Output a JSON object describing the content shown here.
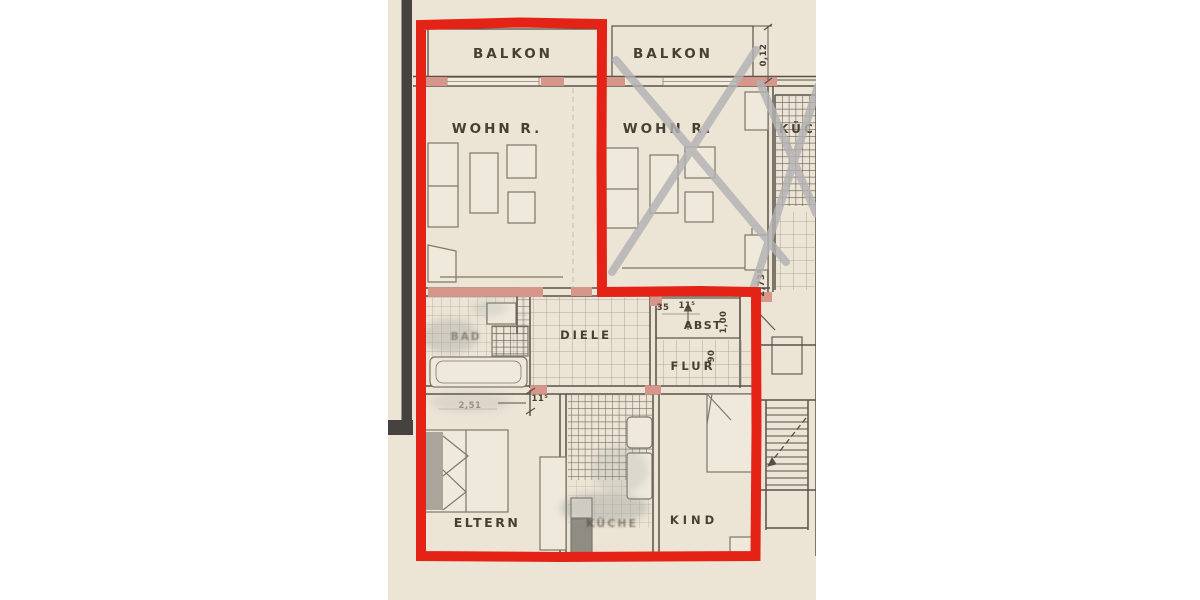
{
  "palette": {
    "paper": "#ece4d5",
    "ink": "#473f33",
    "wall_line": "#57514a",
    "furniture_line": "#7d776b",
    "pink_wall_fill": "#d6968a",
    "highlight_red": "#e42117",
    "cross_grey": "#b3b3b3",
    "dark_bar": "#454341"
  },
  "labels": {
    "balcony_left": "BALKON",
    "balcony_right": "BALKON",
    "living_left": "WOHN R.",
    "living_right": "WOHN R.",
    "kitchen_right": "KÜCHE",
    "bath": "BAD",
    "hallway": "DIELE",
    "storage": "ABST",
    "corridor": "FLUR",
    "parents": "ELTERN",
    "kitchen_bottom": "KÜCHE",
    "child": "KIND"
  },
  "dimensions": {
    "balcony_wall": "0,12",
    "parents_width": "2,51",
    "parents_door": "11⁵",
    "storage_a": "35",
    "storage_b": "11⁵",
    "storage_depth": "1,00",
    "corridor_door": "90",
    "stair_wall": "2,73⁵"
  }
}
